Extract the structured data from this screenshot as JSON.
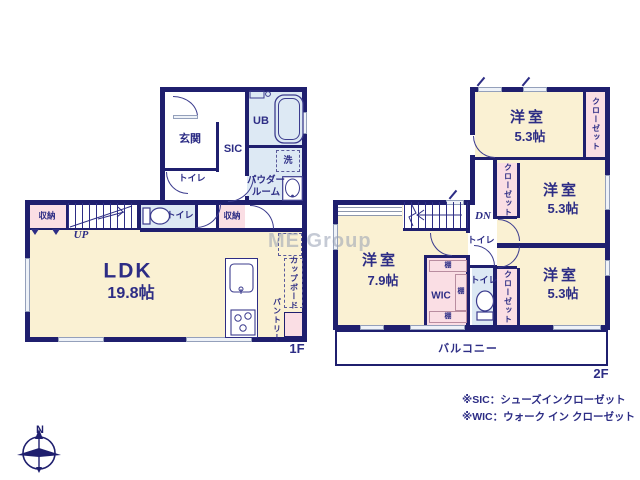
{
  "watermark": "ME Group",
  "colors": {
    "wall": "#1f1f6e",
    "text": "#2d2d85",
    "room_cream": "#faf1d3",
    "wet_blue": "#dde9f4",
    "closet_pink": "#fadee4"
  },
  "floor1": {
    "floor_label": "1F",
    "entrance": "玄関",
    "sic": "SIC",
    "ub": "UB",
    "laundry": "洗",
    "powder_line1": "パウダー",
    "powder_line2": "ルーム",
    "toilet_a": "トイレ",
    "toilet_b": "トイレ",
    "storage_a": "収納",
    "storage_b": "収納",
    "up": "UP",
    "ldk": "LDK",
    "ldk_size": "19.8帖",
    "cupboard": "カップボード",
    "pantry": "パントリー"
  },
  "floor2": {
    "floor_label": "2F",
    "bedrooms": [
      {
        "name": "洋室",
        "size": "5.3帖"
      },
      {
        "name": "洋室",
        "size": "5.3帖"
      },
      {
        "name": "洋室",
        "size": "5.3帖"
      },
      {
        "name": "洋室",
        "size": "7.9帖"
      }
    ],
    "closets": [
      "クローゼット",
      "クローゼット",
      "クローゼット"
    ],
    "wic": "WIC",
    "shelf_a": "棚",
    "shelf_b": "棚",
    "shelf_c": "棚",
    "toilet_a": "トイレ",
    "toilet_b": "トイレ",
    "dn": "DN",
    "balcony": "バルコニー"
  },
  "legend": {
    "sic_note": "※SIC：シューズインクローゼット",
    "wic_note": "※WIC：ウォーク イン クローゼット"
  },
  "compass": {
    "north": "N"
  }
}
